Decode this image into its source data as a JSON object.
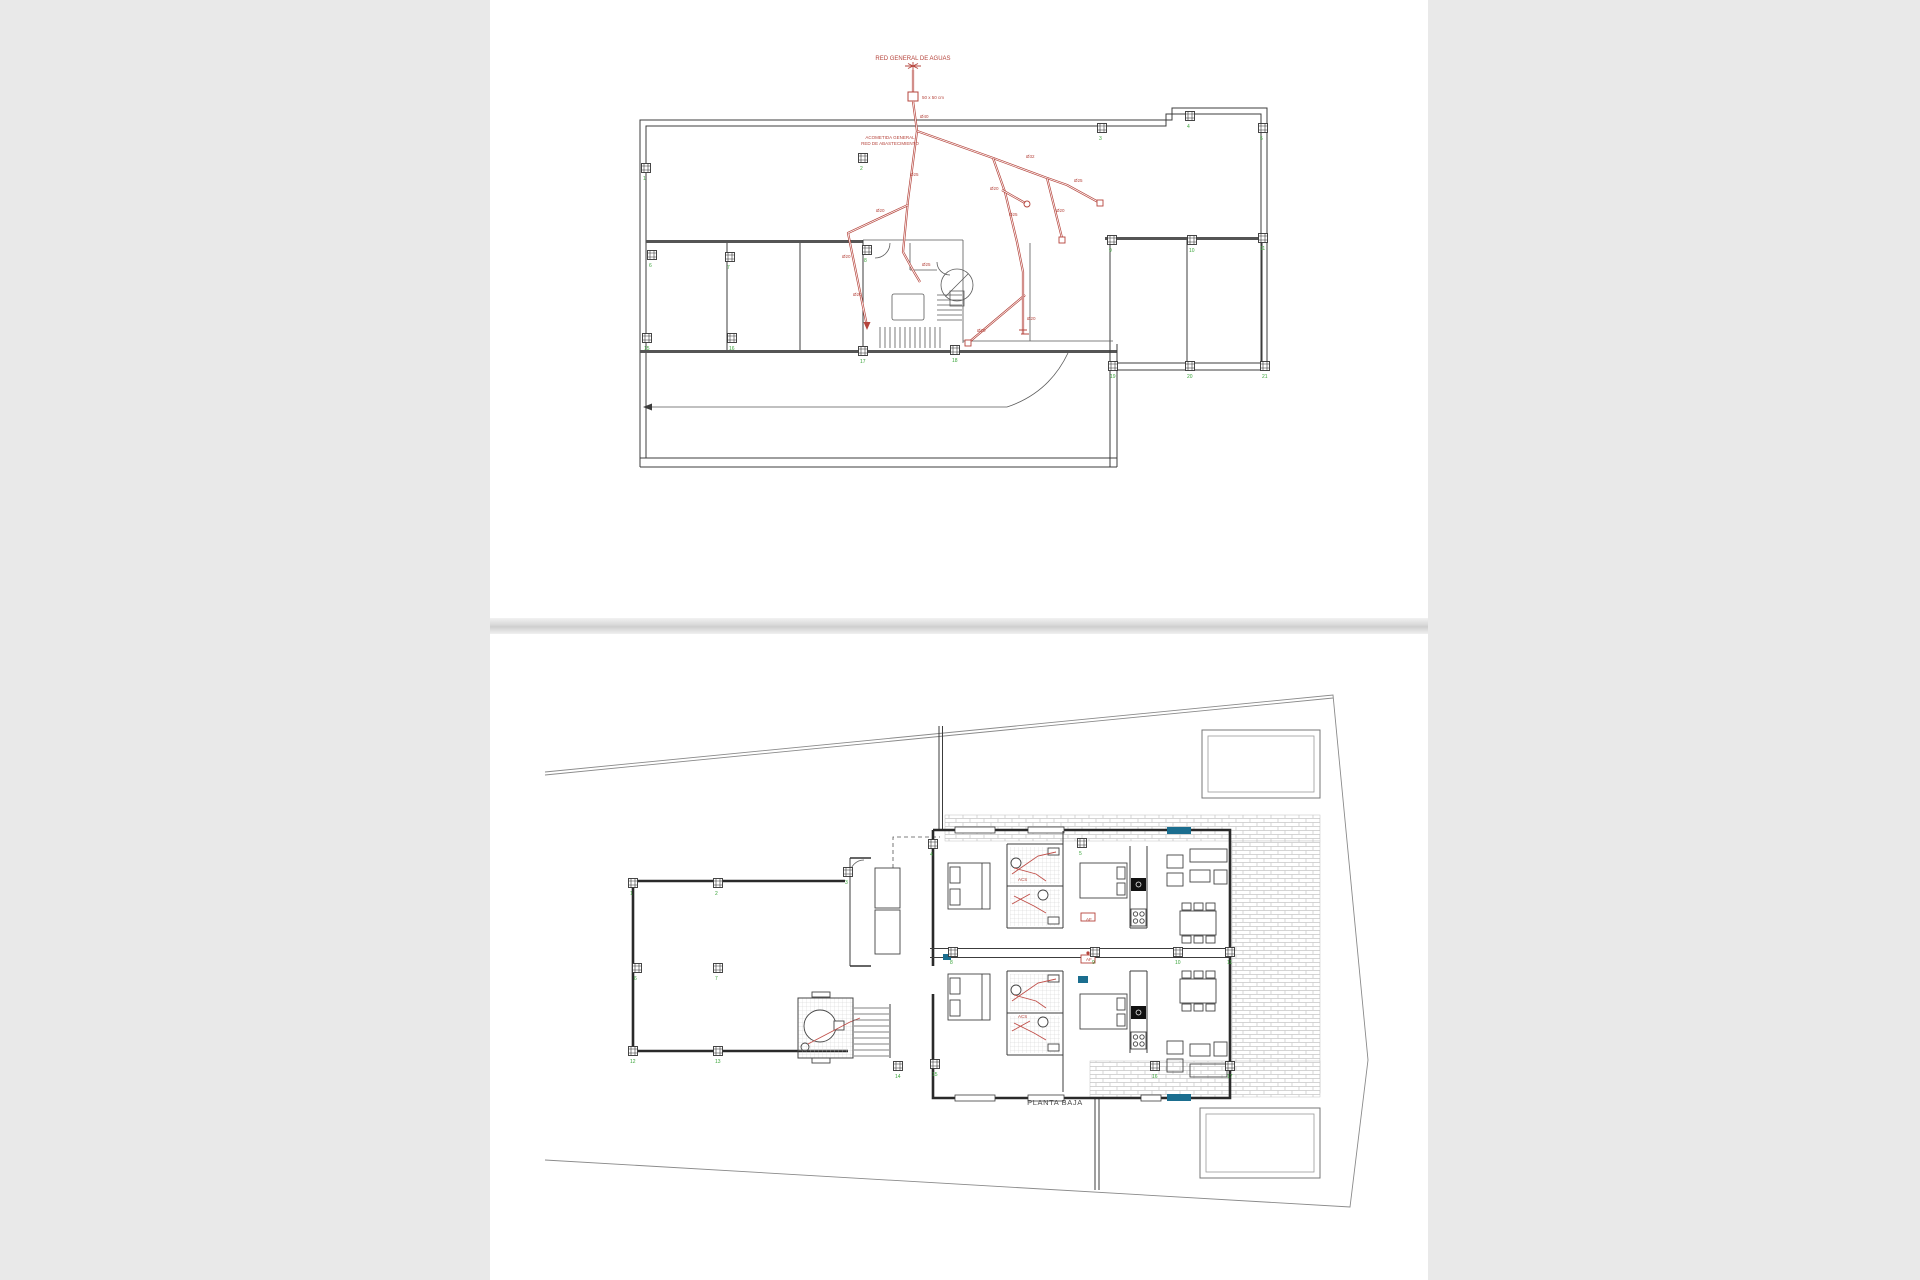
{
  "page": {
    "background": "#e9e9e9",
    "panel_background": "#ffffff",
    "divider_color": "#d7d7d7"
  },
  "colors": {
    "walls": "#3c3c3c",
    "pipes_red": "#b5443c",
    "column_green": "#3aa43a",
    "accent_teal": "#1b6e8f",
    "hatch_gray": "#c6c6c6"
  },
  "top_drawing": {
    "name": "planta cubierta - red de abastecimiento",
    "header_label": "RED GENERAL DE AGUAS",
    "box_label": "50 x 50 cm",
    "note_line1": "ACOMETIDA GENERAL",
    "note_line2": "RED DE ABASTECIMIENTO",
    "pipe_labels": [
      {
        "t": "Ø40",
        "x": 430,
        "y": 118
      },
      {
        "t": "Ø25",
        "x": 420,
        "y": 176
      },
      {
        "t": "Ø20",
        "x": 386,
        "y": 212
      },
      {
        "t": "Ø20",
        "x": 352,
        "y": 258
      },
      {
        "t": "Ø20",
        "x": 363,
        "y": 296
      },
      {
        "t": "Ø32",
        "x": 536,
        "y": 158
      },
      {
        "t": "Ø25",
        "x": 584,
        "y": 182
      },
      {
        "t": "Ø20",
        "x": 566,
        "y": 212
      },
      {
        "t": "Ø25",
        "x": 519,
        "y": 216
      },
      {
        "t": "Ø20",
        "x": 500,
        "y": 190
      },
      {
        "t": "Ø20",
        "x": 537,
        "y": 320
      },
      {
        "t": "Ø25",
        "x": 432,
        "y": 266
      },
      {
        "t": "Ø20",
        "x": 487,
        "y": 332
      }
    ],
    "columns": [
      {
        "n": "1",
        "x": 156,
        "y": 168
      },
      {
        "n": "2",
        "x": 373,
        "y": 158
      },
      {
        "n": "3",
        "x": 612,
        "y": 128
      },
      {
        "n": "4",
        "x": 700,
        "y": 116
      },
      {
        "n": "5",
        "x": 773,
        "y": 128
      },
      {
        "n": "6",
        "x": 162,
        "y": 255
      },
      {
        "n": "7",
        "x": 240,
        "y": 257
      },
      {
        "n": "8",
        "x": 377,
        "y": 250
      },
      {
        "n": "9",
        "x": 622,
        "y": 240
      },
      {
        "n": "10",
        "x": 702,
        "y": 240
      },
      {
        "n": "11",
        "x": 773,
        "y": 238
      },
      {
        "n": "15",
        "x": 157,
        "y": 338
      },
      {
        "n": "16",
        "x": 242,
        "y": 338
      },
      {
        "n": "17",
        "x": 373,
        "y": 351
      },
      {
        "n": "18",
        "x": 465,
        "y": 350
      },
      {
        "n": "19",
        "x": 623,
        "y": 366
      },
      {
        "n": "20",
        "x": 700,
        "y": 366
      },
      {
        "n": "21",
        "x": 775,
        "y": 366
      }
    ]
  },
  "bottom_drawing": {
    "name": "planta baja",
    "title": "PLANTA BAJA",
    "pipe_labels": [
      {
        "t": "ACS",
        "x": 528,
        "y": 247
      },
      {
        "t": "AF",
        "x": 596,
        "y": 287
      },
      {
        "t": "ACS",
        "x": 528,
        "y": 384
      },
      {
        "t": "AF",
        "x": 596,
        "y": 327
      }
    ],
    "columns": [
      {
        "n": "1",
        "x": 143,
        "y": 249
      },
      {
        "n": "2",
        "x": 228,
        "y": 249
      },
      {
        "n": "3",
        "x": 358,
        "y": 238
      },
      {
        "n": "4",
        "x": 443,
        "y": 210
      },
      {
        "n": "5",
        "x": 592,
        "y": 209
      },
      {
        "n": "6",
        "x": 147,
        "y": 334
      },
      {
        "n": "7",
        "x": 228,
        "y": 334
      },
      {
        "n": "8",
        "x": 463,
        "y": 318
      },
      {
        "n": "9",
        "x": 605,
        "y": 318
      },
      {
        "n": "10",
        "x": 688,
        "y": 318
      },
      {
        "n": "11",
        "x": 740,
        "y": 318
      },
      {
        "n": "12",
        "x": 143,
        "y": 417
      },
      {
        "n": "13",
        "x": 228,
        "y": 417
      },
      {
        "n": "14",
        "x": 408,
        "y": 432
      },
      {
        "n": "15",
        "x": 445,
        "y": 430
      },
      {
        "n": "16",
        "x": 665,
        "y": 432
      },
      {
        "n": "17",
        "x": 740,
        "y": 432
      }
    ]
  }
}
